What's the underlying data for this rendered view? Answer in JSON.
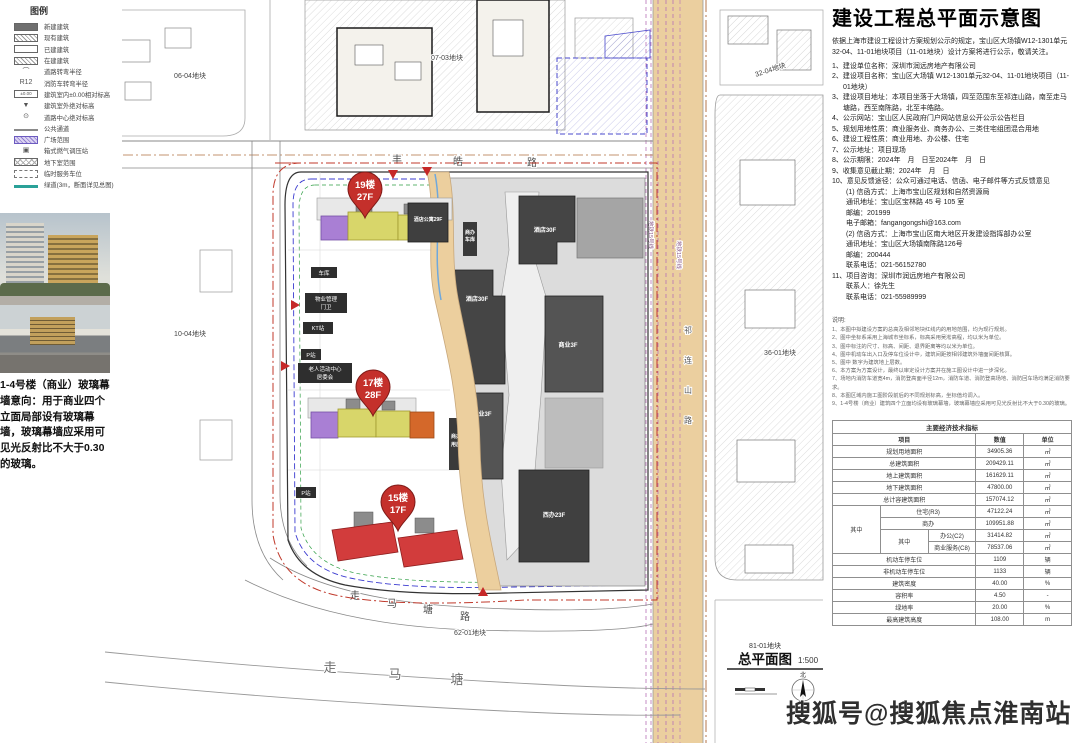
{
  "legend": {
    "title": "图例",
    "items": [
      {
        "label": "新建建筑"
      },
      {
        "label": "现有建筑"
      },
      {
        "label": "已建建筑"
      },
      {
        "label": "在建建筑"
      },
      {
        "label": "道路转弯半径",
        "sym": "⌒"
      },
      {
        "label": "消防车转弯半径",
        "sym": "R12"
      },
      {
        "label": "建筑室内±0.00相对标高",
        "sym": "±0.00"
      },
      {
        "label": "建筑室外绝对标高",
        "sym": "▼"
      },
      {
        "label": "道路中心绝对标高",
        "sym": "⊙"
      },
      {
        "label": "公共通道"
      },
      {
        "label": "广场范围"
      },
      {
        "label": "箱式燃气调压站",
        "sym": "▣"
      },
      {
        "label": "地下室范围"
      },
      {
        "label": "临时服务车位"
      },
      {
        "label": "绿道(3m，断面详见总图)"
      }
    ]
  },
  "photos": {
    "caption": "1-4号楼（商业）玻璃幕墙意向：用于商业四个立面局部设有玻璃幕墙，玻璃幕墙应采用可见光反射比不大于0.30的玻璃。"
  },
  "map": {
    "parcels": {
      "p0604": "06-04地块",
      "p0703": "07-03地块",
      "p1004": "10-04地块",
      "p1102": "11-02地块",
      "p3204": "32-04地块",
      "p3601": "36-01地块",
      "p6201": "62-01地块",
      "p8101": "81-01地块"
    },
    "roads": {
      "fenghao": [
        "丰",
        "皓",
        "路"
      ],
      "zoumatang_lu": [
        "走",
        "马",
        "塘",
        "路"
      ],
      "zoumatang": [
        "走",
        "马",
        "塘"
      ],
      "qilianshan": [
        "祁",
        "连",
        "山",
        "路"
      ],
      "metro": "地铁15号线"
    },
    "pins": [
      {
        "line1": "19楼",
        "line2": "27F"
      },
      {
        "line1": "17楼",
        "line2": "28F"
      },
      {
        "line1": "15楼",
        "line2": "17F"
      }
    ],
    "buildings": {
      "apartment": "酒店公寓29F",
      "hotel_top": "酒店30F",
      "hotel_left": "酒店30F",
      "retail_right": "商业3F",
      "retail_left": "商业3F",
      "west_office": "西办23F",
      "strip1_l1": "商办",
      "strip1_l2": "车库",
      "strip2_l1": "商办",
      "strip2_l2": "用房"
    },
    "facilities": {
      "garage": "车库",
      "property_mgmt": "物业管理",
      "gatehouse": "门卫",
      "kt_station": "KT站",
      "p_station": "P站",
      "elderly_center": "老人活动中心",
      "committee": "居委会"
    },
    "plan_title": "总平面图",
    "plan_scale": "1:500",
    "north_label": "北"
  },
  "notice": {
    "title": "建设工程总平面示意图",
    "intro": "依据上海市建设工程设计方案规划公示的规定，宝山区大场镇W12-1301单元32-04、11-01地块项目（11-01地块）设计方案将进行公示，敬请关注。",
    "items": [
      "1、建设单位名称：深圳市润远房地产有限公司",
      "2、建设项目名称：宝山区大场镇 W12-1301单元32-04、11-01地块项目（11-01地块）",
      "3、建设项目地址：本项目坐落于大场镇，四至范围东至祁连山路，南至走马塘路，西至南陈路，北至丰皓路。",
      "4、公示网站：宝山区人民政府门户网站信息公开公示公告栏目",
      "5、规划用地性质：商业服务业、商务办公、三类住宅组团混合用地",
      "6、建设工程性质：商业用地、办公楼、住宅",
      "7、公示地址：项目现场",
      "8、公示期限：2024年　月　日至2024年　月　日",
      "9、收集意见截止期：2024年　月　日",
      "10、意见反馈途径：公众可通过电话、信函、电子邮件等方式反馈意见"
    ],
    "subs": [
      "(1) 信函方式：上海市宝山区规划和自然资源局",
      "通讯地址：宝山区宝林路 45 号 105 室",
      "邮编：201999",
      "电子邮箱：fangangongshi@163.com",
      "(2) 信函方式：上海市宝山区南大地区开发建设指挥部办公室",
      "通讯地址：宝山区大场镇南陈路126号",
      "邮编：200444",
      "联系电话：021-56152780"
    ],
    "item11": "11、项目咨询：深圳市润远房地产有限公司",
    "item11_subs": [
      "联系人：徐先生",
      "联系电话：021-55989999"
    ]
  },
  "notes": {
    "title": "说明:",
    "lines": [
      "1、本图中拟建设方案的总高及相邻地块红线内的用地范围，均为现行规划。",
      "2、图中坐标系采用上海城市坐标系，标高采用吴淞高程，均以米为单位。",
      "3、图中标注的尺寸、标高、间距、退界距离等均以米为单位。",
      "4、图中机动车出入口及停车位设计中，建筑间距按相邻建筑外墙面间距核算。",
      "5、图中 数字为建筑地上层数。",
      "6、本方案为方案设计，最终以审定设计方案并在施工图设计中进一步深化。",
      "7、场地内消防车道宽4m，消防登高面半径12m，消防车道、消防登高场地、消防回车场均满足消防要求。",
      "8、本图区域内施工图阶段前后的不同规划标高，坐标值均调入。",
      "9、1-4号楼（商业）建筑四个立面均设有玻璃幕墙，玻璃幕墙应采用可见光反射比不大于0.30的玻璃。"
    ]
  },
  "table": {
    "title": "主要经济技术指标",
    "col_item": "项目",
    "col_value": "数值",
    "col_unit": "单位",
    "group1": "其中",
    "group2": "其中",
    "rows": [
      {
        "label": "规划用地面积",
        "value": "34905.36",
        "unit": "㎡"
      },
      {
        "label": "总建筑面积",
        "value": "209429.11",
        "unit": "㎡"
      },
      {
        "label": "地上建筑面积",
        "value": "161629.11",
        "unit": "㎡"
      },
      {
        "label": "地下建筑面积",
        "value": "47800.00",
        "unit": "㎡"
      },
      {
        "label": "总计容建筑面积",
        "value": "157074.12",
        "unit": "㎡"
      },
      {
        "label": "住宅(R3)",
        "value": "47122.24",
        "unit": "㎡"
      },
      {
        "label": "商办",
        "value": "109951.88",
        "unit": "㎡"
      },
      {
        "label": "办公(C2)",
        "value": "31414.82",
        "unit": "㎡"
      },
      {
        "label": "商业服务(C8)",
        "value": "78537.06",
        "unit": "㎡"
      },
      {
        "label": "机动车停车位",
        "value": "1109",
        "unit": "辆"
      },
      {
        "label": "非机动车停车位",
        "value": "1133",
        "unit": "辆"
      },
      {
        "label": "建筑密度",
        "value": "40.00",
        "unit": "%"
      },
      {
        "label": "容积率",
        "value": "4.50",
        "unit": "-"
      },
      {
        "label": "绿地率",
        "value": "20.00",
        "unit": "%"
      },
      {
        "label": "最高建筑高度",
        "value": "108.00",
        "unit": "m"
      }
    ]
  },
  "watermark": "搜狐号@搜狐焦点淮南站"
}
